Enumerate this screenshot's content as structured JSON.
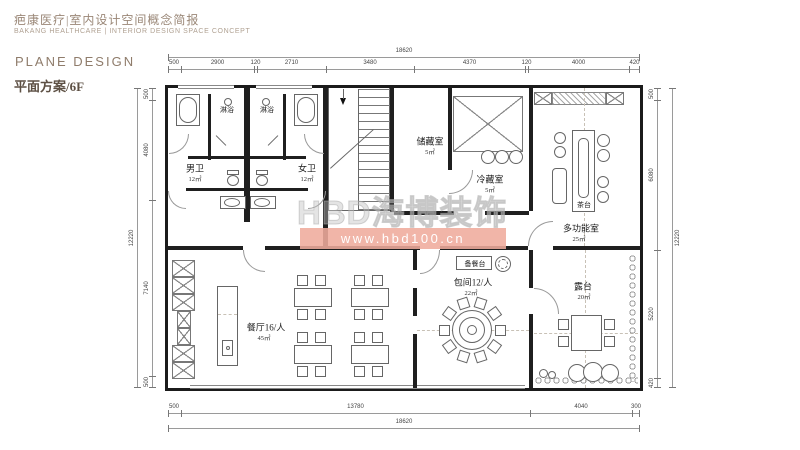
{
  "header": {
    "title_cn": "疤康医疗|室内设计空间概念简报",
    "title_en": "BAKANG HEALTHCARE | INTERIOR DESIGN SPACE CONCEPT"
  },
  "sidebar": {
    "section_en": "PLANE DESIGN",
    "section_cn": "平面方案/6F"
  },
  "watermark": {
    "logo_text": "HBD海博装饰",
    "url_text": "www.hbd100.cn",
    "band_color": "#f0ab9d"
  },
  "plan": {
    "rooms": {
      "male_wc": {
        "name": "男卫",
        "area": "12㎡"
      },
      "female_wc": {
        "name": "女卫",
        "area": "12㎡"
      },
      "shower_left": {
        "name": "淋浴"
      },
      "shower_right": {
        "name": "淋浴"
      },
      "storage": {
        "name": "储藏室",
        "area": "5㎡"
      },
      "cold_storage": {
        "name": "冷藏室",
        "area": "5㎡"
      },
      "tea_table": {
        "name": "茶台"
      },
      "multi_function": {
        "name": "多功能室",
        "area": "25㎡"
      },
      "dining": {
        "name": "餐厅16/人",
        "area": "45㎡"
      },
      "serving_counter": {
        "name": "备餐台"
      },
      "private_room": {
        "name": "包间12/人",
        "area": "22㎡"
      },
      "terrace": {
        "name": "露台",
        "area": "20㎡"
      }
    },
    "dimensions": {
      "top_total": "18620",
      "top_segments": [
        "500",
        "2900",
        "120",
        "2710",
        "3480",
        "4370",
        "120",
        "4000",
        "420"
      ],
      "bottom_total": "18620",
      "bottom_segments": [
        "500",
        "13780",
        "4040",
        "300"
      ],
      "left_total": "12220",
      "left_segments": [
        "500",
        "4080",
        "7140",
        "500"
      ],
      "right_total": "12220",
      "right_segments": [
        "500",
        "6080",
        "5220",
        "420"
      ]
    }
  }
}
